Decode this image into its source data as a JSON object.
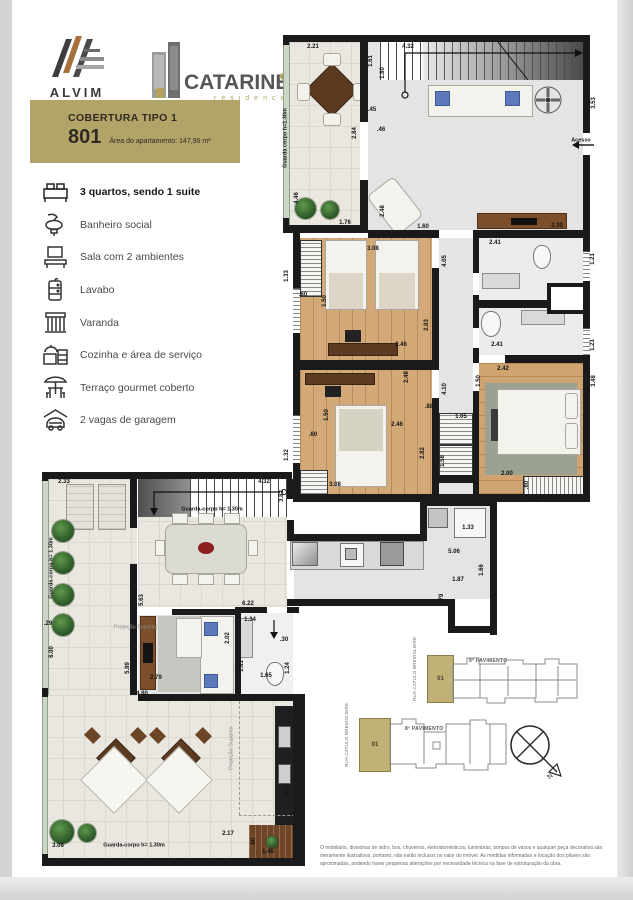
{
  "header": {
    "alvim_name": "ALVIM",
    "alvim_sub": "Construtora",
    "catarine_name": "CATARINE",
    "catarine_sub": "residence"
  },
  "badge": {
    "title": "COBERTURA TIPO 1",
    "number": "801",
    "area": "Área do apartamento: 147,96 m²",
    "bg": "#b2a468"
  },
  "legend": [
    {
      "icon": "bed-icon",
      "label": "3 quartos, sendo 1 suite"
    },
    {
      "icon": "washbasin-icon",
      "label": "Banheiro social"
    },
    {
      "icon": "tv-icon",
      "label": "Sala com 2 ambientes"
    },
    {
      "icon": "lavabo-cabinet-icon",
      "label": "Lavabo"
    },
    {
      "icon": "balcony-railing-icon",
      "label": "Varanda"
    },
    {
      "icon": "kitchen-icon",
      "label": "Cozinha e área de serviço"
    },
    {
      "icon": "umbrella-table-icon",
      "label": "Terraço gourmet coberto"
    },
    {
      "icon": "garage-car-icon",
      "label": "2 vagas de garagem"
    }
  ],
  "plans": {
    "upper": {
      "labels": [
        {
          "t": "2.21",
          "x": 30,
          "y": 14
        },
        {
          "t": "4.32",
          "x": 125,
          "y": 14
        },
        {
          "t": "1.61",
          "x": 88,
          "y": 28,
          "r": 1
        },
        {
          "t": "1.80",
          "x": 100,
          "y": 40,
          "r": 1
        },
        {
          "t": "3.53",
          "x": 311,
          "y": 70,
          "r": 1
        },
        {
          "t": ".45",
          "x": 89,
          "y": 77
        },
        {
          "t": "2.84",
          "x": 72,
          "y": 100,
          "r": 1
        },
        {
          "t": ".46",
          "x": 98,
          "y": 97
        },
        {
          "t": "Guarda corpo h=1.30m",
          "x": 3,
          "y": 105,
          "r": 1,
          "cls": "gc"
        },
        {
          "t": "4.46",
          "x": 14,
          "y": 165,
          "r": 1
        },
        {
          "t": "1.76",
          "x": 62,
          "y": 190
        },
        {
          "t": "2.48",
          "x": 100,
          "y": 178,
          "r": 1
        },
        {
          "t": "1.60",
          "x": 140,
          "y": 194
        },
        {
          "t": "Acesso",
          "x": 298,
          "y": 108,
          "cls": "sm"
        },
        {
          "t": "2.30",
          "x": 274,
          "y": 193
        },
        {
          "t": "2.41",
          "x": 212,
          "y": 210
        },
        {
          "t": "1.21",
          "x": 310,
          "y": 226,
          "r": 1
        },
        {
          "t": "3.08",
          "x": 90,
          "y": 216
        },
        {
          "t": "1.33",
          "x": 4,
          "y": 243,
          "r": 1
        },
        {
          "t": ".60",
          "x": 20,
          "y": 262
        },
        {
          "t": "4.05",
          "x": 162,
          "y": 228,
          "r": 1
        },
        {
          "t": "1.50",
          "x": 42,
          "y": 268,
          "r": 1
        },
        {
          "t": "2.83",
          "x": 144,
          "y": 292,
          "r": 1
        },
        {
          "t": "2.46",
          "x": 118,
          "y": 312
        },
        {
          "t": "2.41",
          "x": 214,
          "y": 312
        },
        {
          "t": "1.21",
          "x": 310,
          "y": 312,
          "r": 1
        },
        {
          "t": "2.42",
          "x": 220,
          "y": 336
        },
        {
          "t": "1.50",
          "x": 196,
          "y": 348,
          "r": 1
        },
        {
          "t": "3.48",
          "x": 311,
          "y": 348,
          "r": 1
        },
        {
          "t": "2.48",
          "x": 124,
          "y": 344,
          "r": 1
        },
        {
          "t": "4.10",
          "x": 162,
          "y": 356,
          "r": 1
        },
        {
          "t": ".88",
          "x": 146,
          "y": 374
        },
        {
          "t": "1.05",
          "x": 178,
          "y": 384
        },
        {
          "t": "1.58",
          "x": 160,
          "y": 428,
          "r": 1
        },
        {
          "t": ".60",
          "x": 30,
          "y": 402
        },
        {
          "t": "1.32",
          "x": 4,
          "y": 422,
          "r": 1
        },
        {
          "t": "1.50",
          "x": 44,
          "y": 382,
          "r": 1
        },
        {
          "t": "3.08",
          "x": 52,
          "y": 452
        },
        {
          "t": "2.82",
          "x": 140,
          "y": 420,
          "r": 1
        },
        {
          "t": "2.46",
          "x": 114,
          "y": 392
        },
        {
          "t": "2.00",
          "x": 224,
          "y": 441
        },
        {
          "t": ".60",
          "x": 244,
          "y": 452,
          "r": 1
        },
        {
          "t": "1.48",
          "x": 252,
          "y": 466
        }
      ]
    },
    "lower": {
      "labels": [
        {
          "t": "2.33",
          "x": 22,
          "y": 14
        },
        {
          "t": "4.32",
          "x": 222,
          "y": 14
        },
        {
          "t": "3.82",
          "x": 240,
          "y": 28,
          "r": 1
        },
        {
          "t": "Guarda-corpo h= 1.30m",
          "x": 170,
          "y": 42,
          "cls": "gc"
        },
        {
          "t": "Guarda-corpo h= 1.30m",
          "x": 10,
          "y": 100,
          "r": 1,
          "cls": "gc"
        },
        {
          "t": "1.33",
          "x": 426,
          "y": 60
        },
        {
          "t": "5.06",
          "x": 412,
          "y": 84
        },
        {
          "t": "1.66",
          "x": 440,
          "y": 102,
          "r": 1
        },
        {
          "t": "1.87",
          "x": 416,
          "y": 112
        },
        {
          "t": ".79",
          "x": 400,
          "y": 130,
          "r": 1
        },
        {
          "t": "5.63",
          "x": 100,
          "y": 132,
          "r": 1
        },
        {
          "t": "6.22",
          "x": 206,
          "y": 136
        },
        {
          "t": "1.34",
          "x": 208,
          "y": 152
        },
        {
          "t": ".29",
          "x": 6,
          "y": 156
        },
        {
          "t": "Projeção Superior",
          "x": 94,
          "y": 160,
          "cls": "ps"
        },
        {
          "t": "6.00",
          "x": 10,
          "y": 184,
          "r": 1
        },
        {
          "t": "2.02",
          "x": 186,
          "y": 170,
          "r": 1
        },
        {
          "t": ".30",
          "x": 242,
          "y": 172
        },
        {
          "t": "1.81",
          "x": 200,
          "y": 198,
          "r": 1
        },
        {
          "t": "1.65",
          "x": 224,
          "y": 208
        },
        {
          "t": "1.24",
          "x": 246,
          "y": 200,
          "r": 1
        },
        {
          "t": "5.99",
          "x": 86,
          "y": 200,
          "r": 1
        },
        {
          "t": "2.79",
          "x": 114,
          "y": 210
        },
        {
          "t": "4.80",
          "x": 100,
          "y": 226
        },
        {
          "t": "Projeção Superior",
          "x": 190,
          "y": 280,
          "r": 1,
          "cls": "ps"
        },
        {
          "t": "4.87",
          "x": 246,
          "y": 322,
          "r": 1
        },
        {
          "t": "2.17",
          "x": 186,
          "y": 366
        },
        {
          "t": "3.08",
          "x": 16,
          "y": 378
        },
        {
          "t": "Guarda-corpo h= 1.30m",
          "x": 92,
          "y": 378,
          "cls": "gc"
        },
        {
          "t": ".60",
          "x": 212,
          "y": 374,
          "r": 1
        },
        {
          "t": "1.48",
          "x": 226,
          "y": 384
        }
      ]
    }
  },
  "keyplans": {
    "street": "RUA CATULO BREVIGLIERE",
    "floor9": "9º PAVIMENTO",
    "floor8": "8º PAVIMENTO",
    "unit": "01",
    "north": "N"
  },
  "disclaimer": "O mobiliário, divisórias de vidro, box, chuveiros, eletrodomésticos, luminárias, tampos de vasos e qualquer peça decorativa são meramente ilustrativos, portanto, não estão inclusos no valor do imóvel. As medidas informadas e locação dos pilares são aproximadas, podendo haver pequenas alterações por necessidade técnica na fase de estruturação da obra."
}
